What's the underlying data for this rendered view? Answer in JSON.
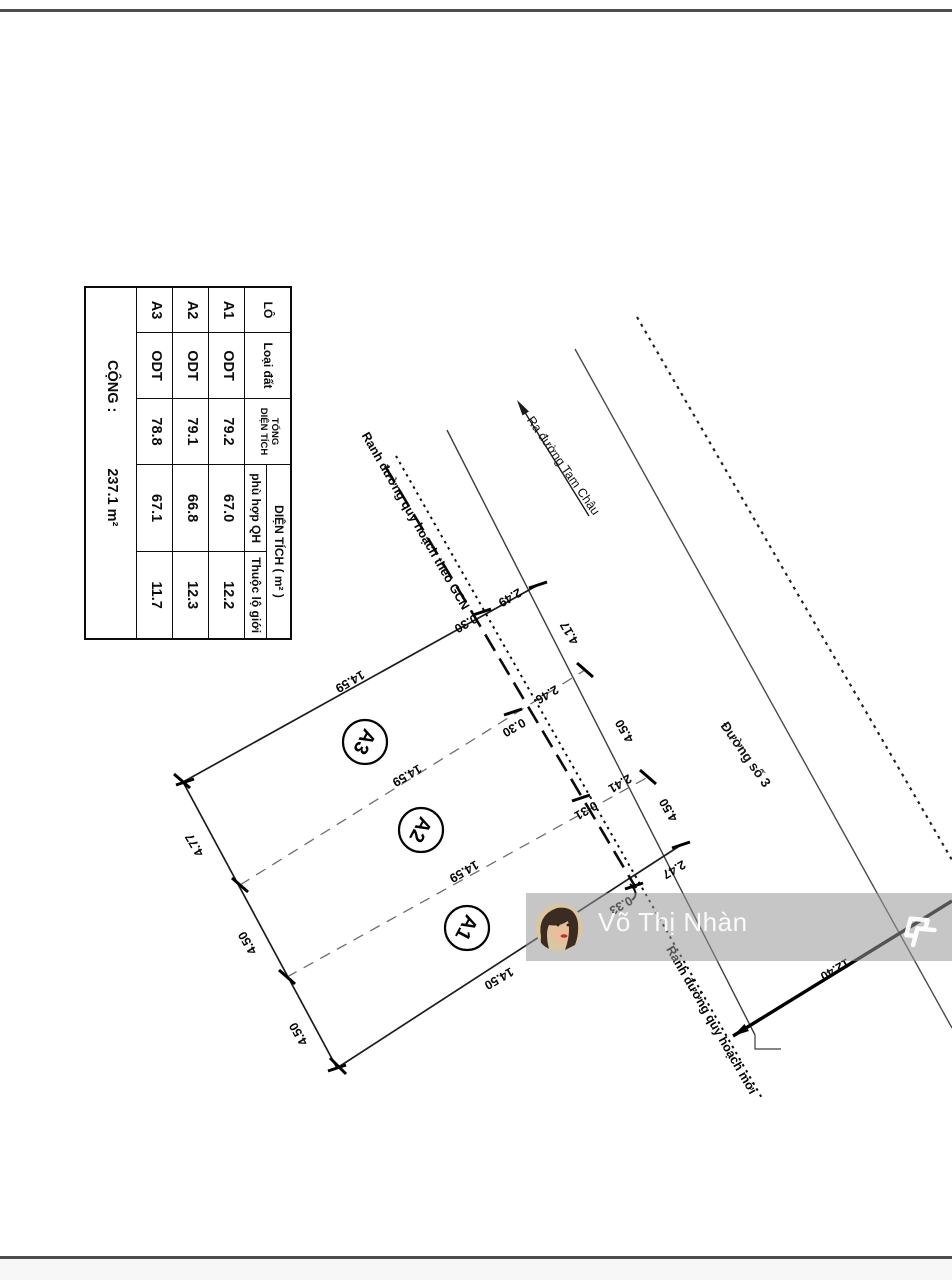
{
  "table": {
    "headers": {
      "lo": "LÔ",
      "loai_dat": "Loại đất",
      "tong_line1": "TỔNG",
      "tong_line2": "DIỆN TÍCH",
      "dien_tich_group": "DIỆN TÍCH ( m² )",
      "phu_hop": "phù hợp QH",
      "thuoc_lo_gioi": "Thuộc lộ giới"
    },
    "rows": [
      {
        "lo": "A1",
        "loai": "ODT",
        "tong": "79.2",
        "phu_hop": "67.0",
        "lo_gioi": "12.2"
      },
      {
        "lo": "A2",
        "loai": "ODT",
        "tong": "79.1",
        "phu_hop": "66.8",
        "lo_gioi": "12.3"
      },
      {
        "lo": "A3",
        "loai": "ODT",
        "tong": "78.8",
        "phu_hop": "67.1",
        "lo_gioi": "11.7"
      }
    ],
    "footer": {
      "label": "CỘNG :",
      "value": "237.1 m²"
    }
  },
  "diagram": {
    "lots": [
      "A3",
      "A2",
      "A1"
    ],
    "dims": {
      "edge_top": "14.59",
      "div_a3a2": "14.59",
      "div_a2a1": "14.59",
      "edge_bottom": "14.50",
      "left_a3": "4.77",
      "left_a2": "4.50",
      "left_a1": "4.50",
      "right_a3": "4.17",
      "right_a2": "4.50",
      "right_a1": "4.50",
      "cut_top": "2.49",
      "cut_a3a2": "2.46",
      "cut_a2a1": "2.41",
      "cut_bottom": "2.47",
      "off_top": "0.30",
      "off_a3a2": "0.30",
      "off_a2a1": "0.31",
      "off_bottom": "0.33",
      "road_width": "12.40"
    },
    "labels": {
      "road": "Đường số 3",
      "to_road": "Ra đường Tam Châu",
      "gcn_boundary": "Ranh đường quy hoạch theo GCN",
      "new_boundary": "Ranh đường quy hoạch mới"
    }
  },
  "watermark": {
    "name": "Võ Thị Nhàn"
  }
}
